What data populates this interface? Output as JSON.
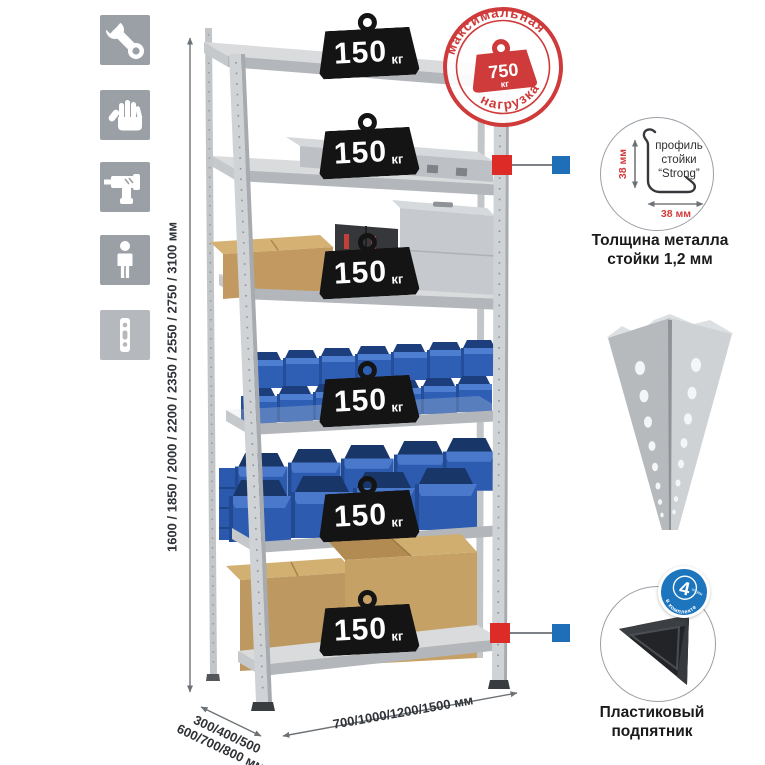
{
  "colors": {
    "accent_red": "#d23b3b",
    "callout_blue": "#1e6fb8",
    "bin_blue": "#2e5fb4",
    "metal_gray": "#cdd0d3",
    "badge_black": "#141414",
    "icon_gray": "#9aa0a5"
  },
  "icons": {
    "left_column": [
      "wrench-icon",
      "gloves-icon",
      "drill-icon",
      "person-icon",
      "rack-post-icon"
    ]
  },
  "dimensions": {
    "height": "1600 / 1850 / 2000 / 2200 / 2350 / 2550 / 2750 / 3100 мм",
    "depth_line1": "300/400/500",
    "depth_line2": "600/700/800 мм",
    "width": "700/1000/1200/1500 мм"
  },
  "stamp": {
    "arc_top": "максимальная",
    "arc_bottom": "нагрузка",
    "value": "750",
    "unit": "кг"
  },
  "shelf_badge": {
    "value": "150",
    "unit": "кг",
    "count": 6
  },
  "profile_callout": {
    "dim_vertical": "38 мм",
    "dim_horizontal": "38 мм",
    "label_line1": "профиль",
    "label_line2": "стойки",
    "label_line3": "“Strong”",
    "caption_line1": "Толщина металла",
    "caption_line2": "стойки 1,2 мм"
  },
  "foot_callout": {
    "badge_number": "4",
    "badge_qty_word": "штуки",
    "badge_arc": "в комплекте",
    "caption_line1": "Пластиковый",
    "caption_line2": "подпятник"
  }
}
